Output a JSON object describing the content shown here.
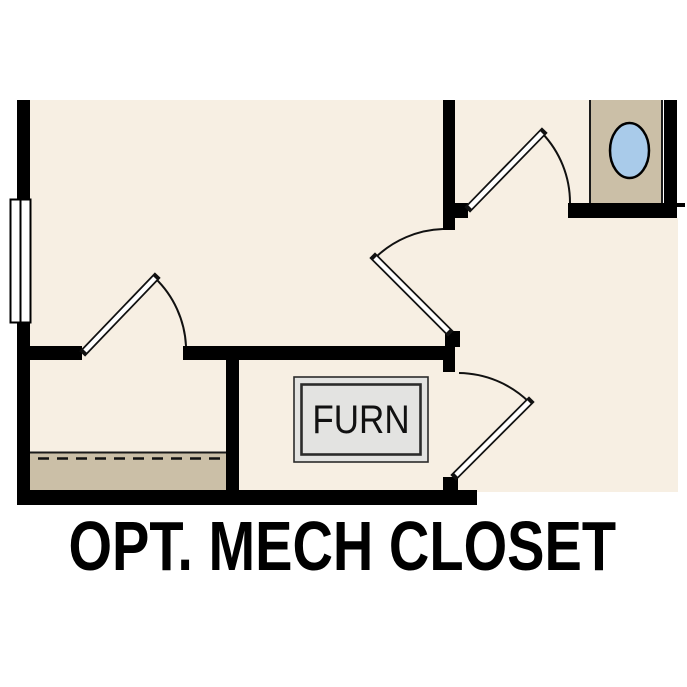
{
  "title": {
    "label": "OPT. MECH CLOSET"
  },
  "floor_plan": {
    "furnace_label": "FURN",
    "colors": {
      "floor_cream": "#F7EFE3",
      "shelf_tan": "#CBBFA7",
      "vanity_tan": "#CBBFA7",
      "sink_blue": "#A9CBEA",
      "furnace_gray": "#E3E3E1",
      "wall_black": "#000000",
      "window_white": "#ffffff",
      "title_black": "#000000"
    },
    "features": {
      "window": "left exterior wall window",
      "closet_shelf": "shelf with dashed hanging rod line",
      "sink": "oval lavatory in vanity",
      "doors": "four swing doors with quarter arcs",
      "furnace": "FURN unit in mechanical closet"
    }
  }
}
